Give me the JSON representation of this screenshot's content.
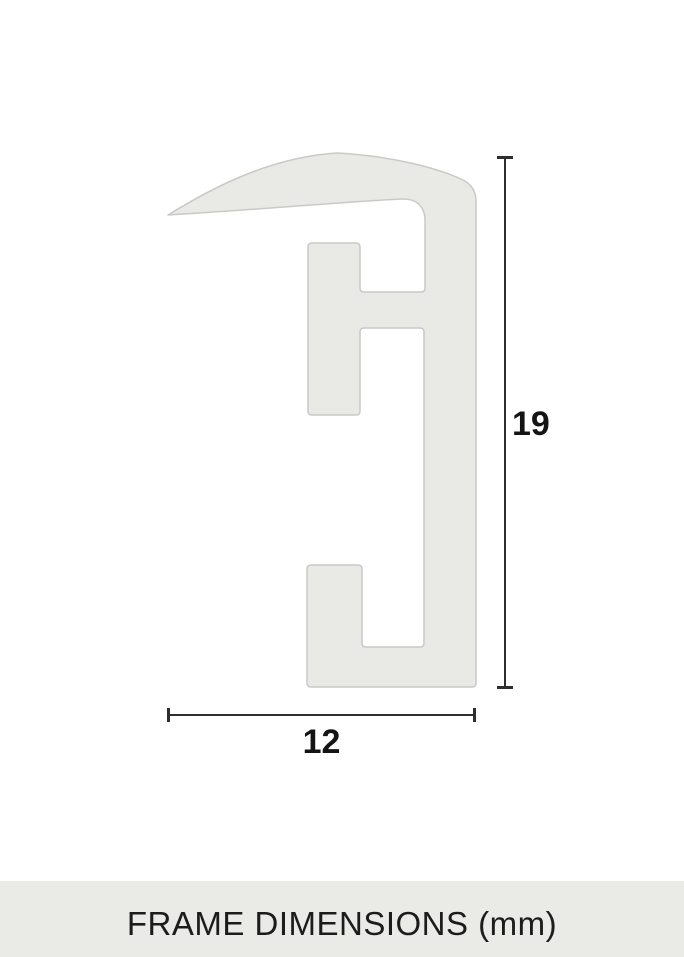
{
  "diagram": {
    "height_label": "19",
    "width_label": "12",
    "dimensions_mm": {
      "height": 19,
      "width": 12
    },
    "unit": "mm"
  },
  "footer": {
    "title": "FRAME DIMENSIONS (mm)"
  },
  "colors": {
    "background": "#ffffff",
    "profile_fill": "#e9e9e5",
    "profile_stroke": "#c9c9c6",
    "dimension_line": "#2e2e2e",
    "label_text": "#141414",
    "footer_bg": "#eaeae6",
    "footer_text": "#1c1c1c"
  }
}
